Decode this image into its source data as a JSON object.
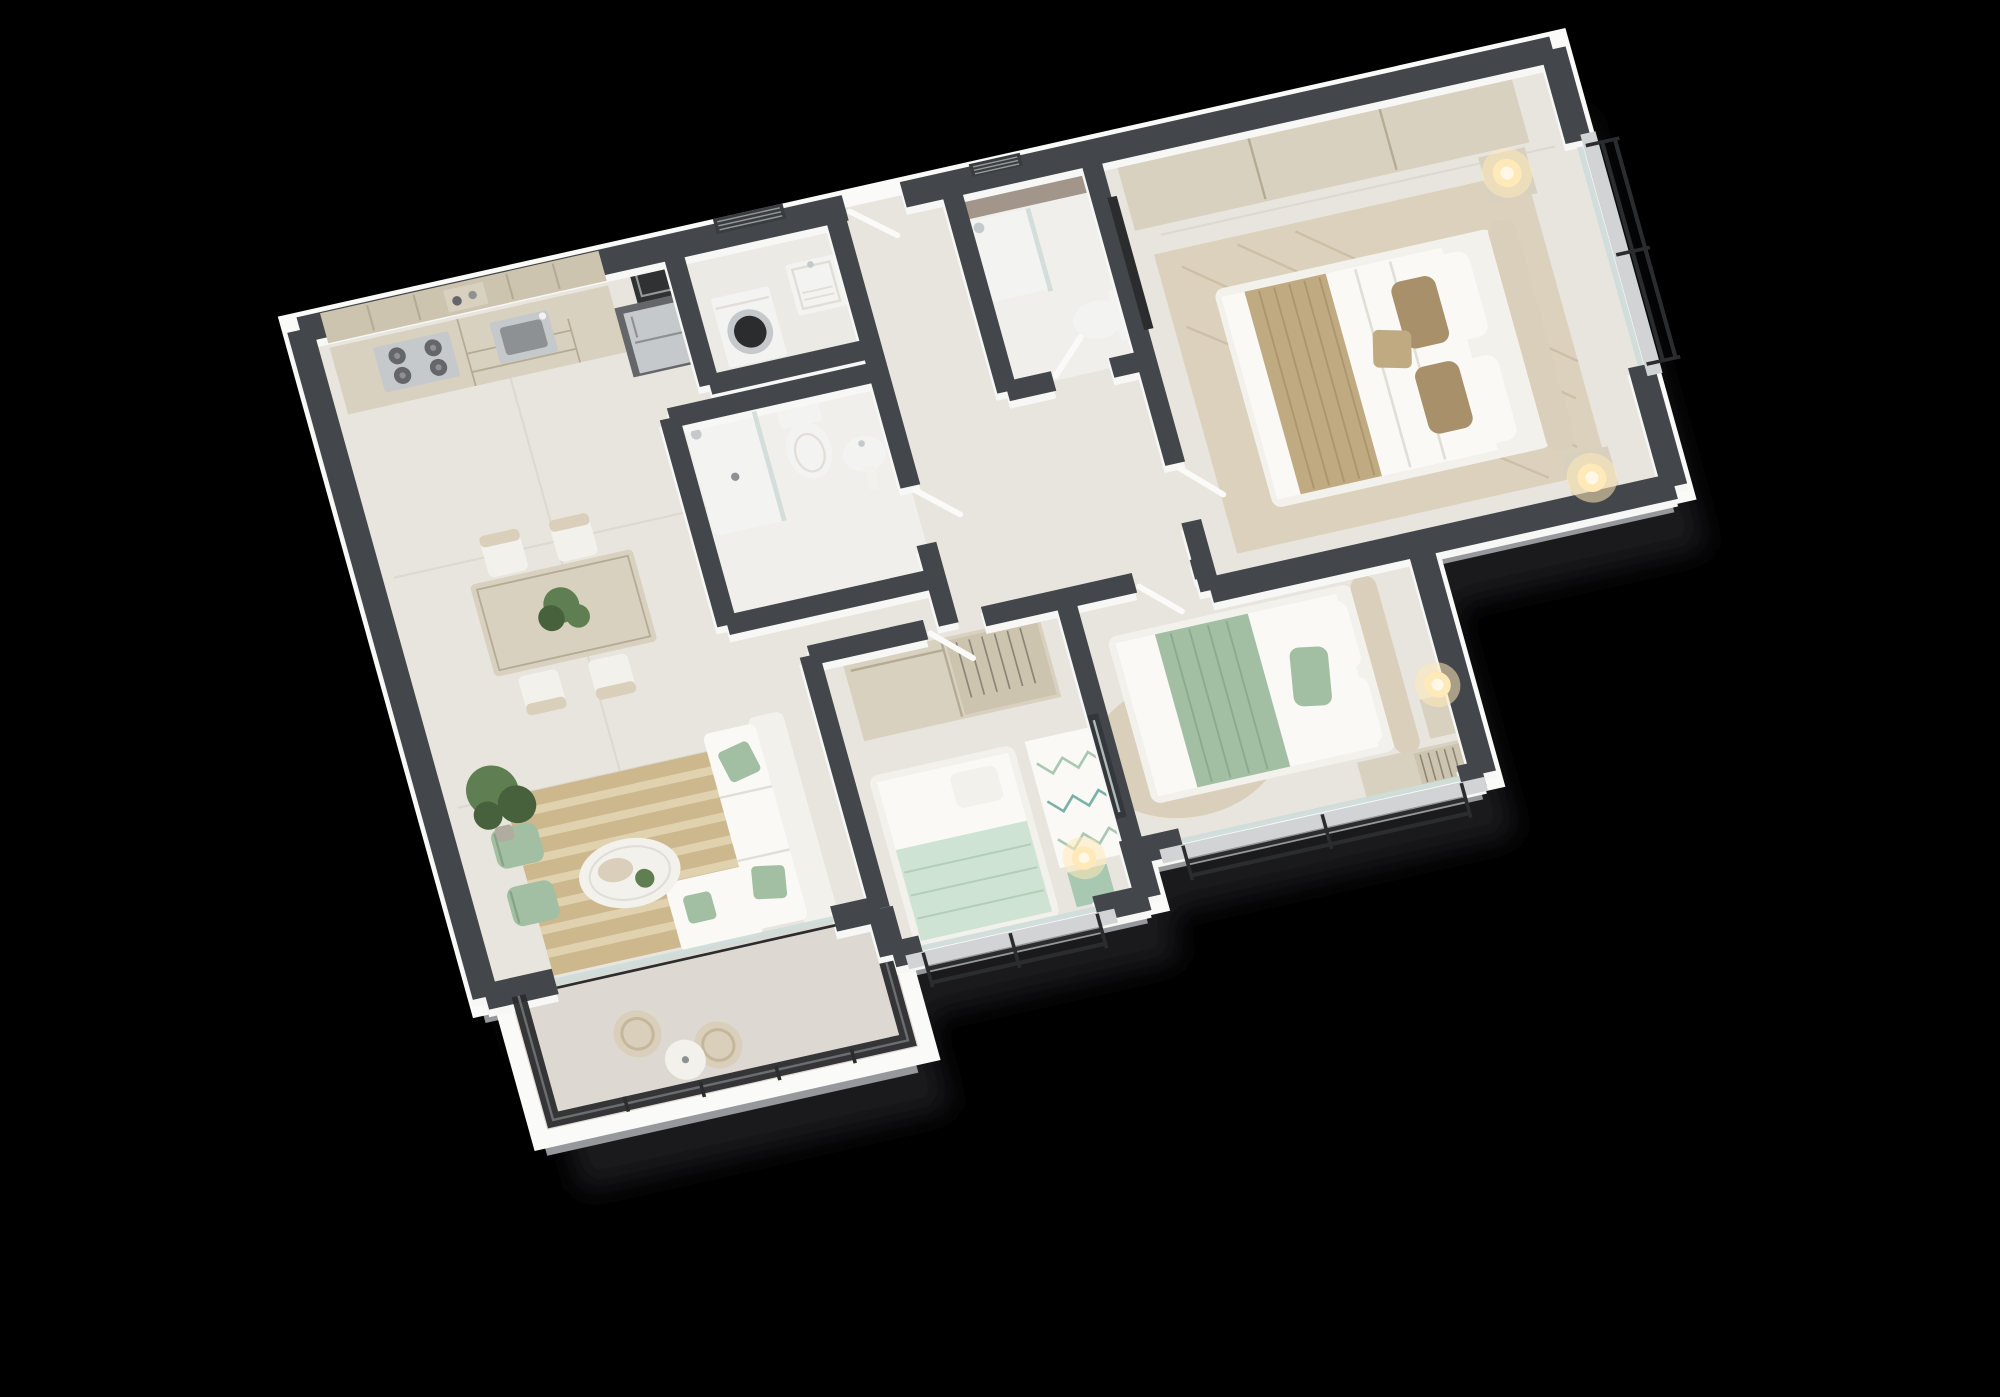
{
  "meta": {
    "label": "isometric-3d-apartment-floor-plan"
  },
  "scene": {
    "type": "isometric-floor-plan",
    "background": "black",
    "view": "3d-cutaway-top-down"
  },
  "palette": {
    "background": "#000000",
    "shadow": "#26262a",
    "wall_top": "#43464a",
    "wall_inner": "#f7f7f6",
    "wall_outer_light": "#d6d7d8",
    "wall_outer_mid": "#96989b",
    "floor_main": "#e8e5de",
    "floor_bath": "#f0efeb",
    "floor_laundry": "#eceae5",
    "floor_balcony": "#ddd9d2",
    "tile_brown": "#a2968a",
    "wood_light": "#d8d1bf",
    "wood_mid": "#ccc4af",
    "wood_line": "#b4ab94",
    "counter_dark": "#64666a",
    "steel": "#c6c9cb",
    "steel_dark": "#8e9193",
    "appliance_white": "#f3f3f1",
    "white_soft": "#f3f1ec",
    "linen": "#faf9f5",
    "tan": "#c0aa82",
    "tan_dark": "#a8916a",
    "sage": "#a3bfa3",
    "sage_dark": "#86a586",
    "mint": "#cfe3d4",
    "mint_dark": "#a9c8b2",
    "teal_accent": "#7ab1a8",
    "jute": "#cdb78d",
    "jute_line": "#e0d2ae",
    "rug_beige": "#d9cfba",
    "rug_line": "#c4b89c",
    "seam_line": "#e0ded6",
    "rail_black": "#2b2c2e",
    "rail_gray": "#6b6d70",
    "glass": "#cfdcd9",
    "door_white": "#fafaf8",
    "lamp_glow": "#ffe9b8",
    "lamp_core": "#fff8e6",
    "plant_green": "#5f7f53",
    "plant_dark": "#46613c",
    "pot_gray": "#b1aca0",
    "mirror_dark": "#34373b",
    "vent_dark": "#3a3d40",
    "vent_line": "#969899",
    "duct_dark": "#2f3133",
    "sill_gray": "#d2d3d4",
    "hanger_gray": "#8a8477"
  },
  "rooms": [
    {
      "id": "kitchen",
      "furniture": [
        "upper-cabinets",
        "open-shelf",
        "base-cabinet-run",
        "gas-cooktop",
        "kitchen-sink",
        "tall-counter-unit",
        "refrigerator"
      ]
    },
    {
      "id": "laundry",
      "furniture": [
        "washing-machine",
        "utility-sink",
        "louver-vent",
        "service-shaft"
      ]
    },
    {
      "id": "bathroom",
      "furniture": [
        "walk-in-shower",
        "glass-screen",
        "toilet",
        "pedestal-sink",
        "towel-bar"
      ]
    },
    {
      "id": "ensuite-bathroom",
      "furniture": [
        "tiled-shower-wall",
        "walk-in-shower",
        "glass-screen",
        "toilet",
        "louver-vent"
      ]
    },
    {
      "id": "master-bedroom",
      "furniture": [
        "sliding-door-wardrobe",
        "double-bed",
        "headboard",
        "nightstand-left",
        "nightstand-right",
        "table-lamp-left",
        "table-lamp-right",
        "herringbone-rug",
        "tv-panel",
        "window-railing"
      ]
    },
    {
      "id": "bedroom-2",
      "furniture": [
        "double-bed",
        "headboard",
        "round-rug",
        "nightstand",
        "table-lamp",
        "open-closet",
        "window-railing"
      ]
    },
    {
      "id": "bedroom-3",
      "furniture": [
        "single-bed",
        "sliding-door-wardrobe",
        "open-hanging-rack",
        "zigzag-rug",
        "nightstand",
        "table-lamp",
        "wall-mirror",
        "window-railing"
      ]
    },
    {
      "id": "dining-area",
      "furniture": [
        "dining-table",
        "dining-chair-1",
        "dining-chair-2",
        "dining-chair-3",
        "dining-chair-4",
        "plant-centerpiece"
      ]
    },
    {
      "id": "living-room",
      "furniture": [
        "l-shaped-sofa",
        "accent-pillows",
        "jute-striped-rug",
        "oval-coffee-table",
        "fiddle-leaf-plant",
        "armchair-1",
        "armchair-2",
        "sliding-glass-door"
      ]
    },
    {
      "id": "balcony",
      "furniture": [
        "rattan-chair-1",
        "rattan-chair-2",
        "side-table",
        "mesh-railing"
      ]
    }
  ]
}
